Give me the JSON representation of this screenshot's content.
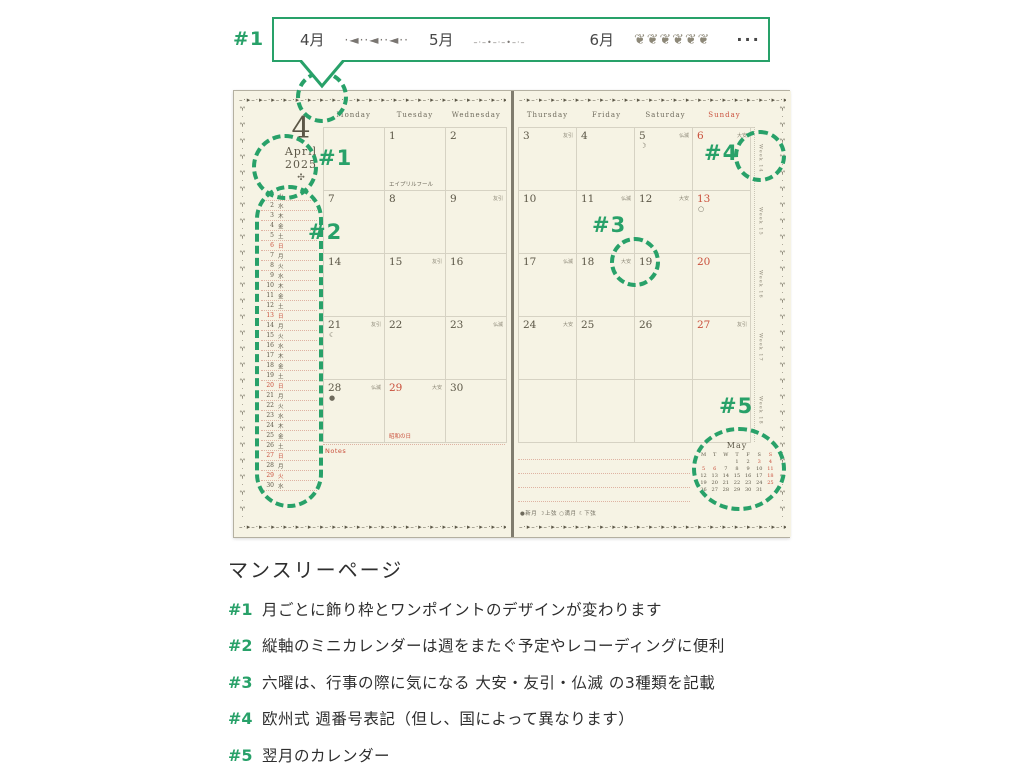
{
  "colors": {
    "green": "#28a169",
    "red": "#c94f3b",
    "cream": "#f6f3e4",
    "ink": "#5c5747"
  },
  "callout": {
    "label": "#1",
    "items": [
      {
        "month": "4月",
        "type": "arrows",
        "decor": "·◄··◄··◄··"
      },
      {
        "month": "5月",
        "type": "lines",
        "decor": "–·–•–·–•–·–"
      },
      {
        "month": "6月",
        "type": "floral",
        "decor": "❦❦❦❦❦❦"
      }
    ],
    "ellipsis": "···"
  },
  "border_motifs": {
    "horizontal": "–·▸",
    "vertical": "♈·"
  },
  "badges": {
    "b1": "#1",
    "b2": "#2",
    "b3": "#3",
    "b4": "#4",
    "b5": "#5"
  },
  "planner": {
    "left_page": {
      "month_number": "4",
      "month_name": "April",
      "year": "2025",
      "ornament": "✣",
      "notes_label": "Notes",
      "mini_calendar": [
        {
          "d": "1",
          "w": "火",
          "red": false
        },
        {
          "d": "2",
          "w": "水",
          "red": false
        },
        {
          "d": "3",
          "w": "木",
          "red": false
        },
        {
          "d": "4",
          "w": "金",
          "red": false
        },
        {
          "d": "5",
          "w": "土",
          "red": false
        },
        {
          "d": "6",
          "w": "日",
          "red": true
        },
        {
          "d": "7",
          "w": "月",
          "red": false
        },
        {
          "d": "8",
          "w": "火",
          "red": false
        },
        {
          "d": "9",
          "w": "水",
          "red": false
        },
        {
          "d": "10",
          "w": "木",
          "red": false
        },
        {
          "d": "11",
          "w": "金",
          "red": false
        },
        {
          "d": "12",
          "w": "土",
          "red": false
        },
        {
          "d": "13",
          "w": "日",
          "red": true
        },
        {
          "d": "14",
          "w": "月",
          "red": false
        },
        {
          "d": "15",
          "w": "火",
          "red": false
        },
        {
          "d": "16",
          "w": "水",
          "red": false
        },
        {
          "d": "17",
          "w": "木",
          "red": false
        },
        {
          "d": "18",
          "w": "金",
          "red": false
        },
        {
          "d": "19",
          "w": "土",
          "red": false
        },
        {
          "d": "20",
          "w": "日",
          "red": true
        },
        {
          "d": "21",
          "w": "月",
          "red": false
        },
        {
          "d": "22",
          "w": "火",
          "red": false
        },
        {
          "d": "23",
          "w": "水",
          "red": false
        },
        {
          "d": "24",
          "w": "木",
          "red": false
        },
        {
          "d": "25",
          "w": "金",
          "red": false
        },
        {
          "d": "26",
          "w": "土",
          "red": false
        },
        {
          "d": "27",
          "w": "日",
          "red": true
        },
        {
          "d": "28",
          "w": "月",
          "red": false
        },
        {
          "d": "29",
          "w": "火",
          "red": true
        },
        {
          "d": "30",
          "w": "水",
          "red": false
        }
      ],
      "weekday_headers": [
        {
          "label": "Monday",
          "red": false
        },
        {
          "label": "Tuesday",
          "red": false
        },
        {
          "label": "Wednesday",
          "red": false
        }
      ],
      "weeks": [
        [
          {
            "day": ""
          },
          {
            "day": "1",
            "note": "エイプリルフール"
          },
          {
            "day": "2"
          }
        ],
        [
          {
            "day": "7"
          },
          {
            "day": "8"
          },
          {
            "day": "9",
            "rokuyo": "友引"
          }
        ],
        [
          {
            "day": "14"
          },
          {
            "day": "15",
            "rokuyo": "友引"
          },
          {
            "day": "16"
          }
        ],
        [
          {
            "day": "21",
            "rokuyo": "友引",
            "moon": "☾"
          },
          {
            "day": "22"
          },
          {
            "day": "23",
            "rokuyo": "仏滅"
          }
        ],
        [
          {
            "day": "28",
            "rokuyo": "仏滅",
            "moon": "●"
          },
          {
            "day": "29",
            "red": true,
            "rokuyo": "大安",
            "note": "昭和の日",
            "note_red": true
          },
          {
            "day": "30"
          }
        ]
      ]
    },
    "right_page": {
      "weekday_headers": [
        {
          "label": "Thursday",
          "red": false
        },
        {
          "label": "Friday",
          "red": false
        },
        {
          "label": "Saturday",
          "red": false
        },
        {
          "label": "Sunday",
          "red": true
        }
      ],
      "weeks": [
        [
          {
            "day": "3",
            "rokuyo": "友引"
          },
          {
            "day": "4"
          },
          {
            "day": "5",
            "rokuyo": "仏滅",
            "moon": "☽"
          },
          {
            "day": "6",
            "red": true,
            "rokuyo": "大安"
          }
        ],
        [
          {
            "day": "10"
          },
          {
            "day": "11",
            "rokuyo": "仏滅"
          },
          {
            "day": "12",
            "rokuyo": "大安"
          },
          {
            "day": "13",
            "red": true,
            "moon": "○"
          }
        ],
        [
          {
            "day": "17",
            "rokuyo": "仏滅"
          },
          {
            "day": "18",
            "rokuyo": "大安"
          },
          {
            "day": "19"
          },
          {
            "day": "20",
            "red": true
          }
        ],
        [
          {
            "day": "24",
            "rokuyo": "大安"
          },
          {
            "day": "25"
          },
          {
            "day": "26"
          },
          {
            "day": "27",
            "red": true,
            "rokuyo": "友引"
          }
        ],
        [
          {
            "day": ""
          },
          {
            "day": ""
          },
          {
            "day": ""
          },
          {
            "day": ""
          }
        ]
      ],
      "week_numbers": [
        "Week 14",
        "Week 15",
        "Week 16",
        "Week 17",
        "Week 18"
      ],
      "moon_legend": "●新月 ☽上弦 ○満月 ☾下弦",
      "next_month": {
        "title": "May",
        "dow": [
          "M",
          "T",
          "W",
          "T",
          "F",
          "S",
          "S"
        ],
        "dow_red_last": true,
        "weeks": [
          [
            "",
            "",
            "",
            "1",
            "2",
            "3",
            "4"
          ],
          [
            "5",
            "6",
            "7",
            "8",
            "9",
            "10",
            "11"
          ],
          [
            "12",
            "13",
            "14",
            "15",
            "16",
            "17",
            "18"
          ],
          [
            "19",
            "20",
            "21",
            "22",
            "23",
            "24",
            "25"
          ],
          [
            "26",
            "27",
            "28",
            "29",
            "30",
            "31",
            ""
          ]
        ],
        "red_days": [
          "3",
          "4",
          "5",
          "6",
          "11",
          "18",
          "25"
        ]
      }
    }
  },
  "legend": {
    "title": "マンスリーページ",
    "items": [
      {
        "tag": "#1",
        "text": "月ごとに飾り枠とワンポイントのデザインが変わります"
      },
      {
        "tag": "#2",
        "text": "縦軸のミニカレンダーは週をまたぐ予定やレコーディングに便利"
      },
      {
        "tag": "#3",
        "text": "六曜は、行事の際に気になる 大安・友引・仏滅 の3種類を記載"
      },
      {
        "tag": "#4",
        "text": "欧州式 週番号表記（但し、国によって異なります）"
      },
      {
        "tag": "#5",
        "text": "翌月のカレンダー"
      }
    ]
  }
}
